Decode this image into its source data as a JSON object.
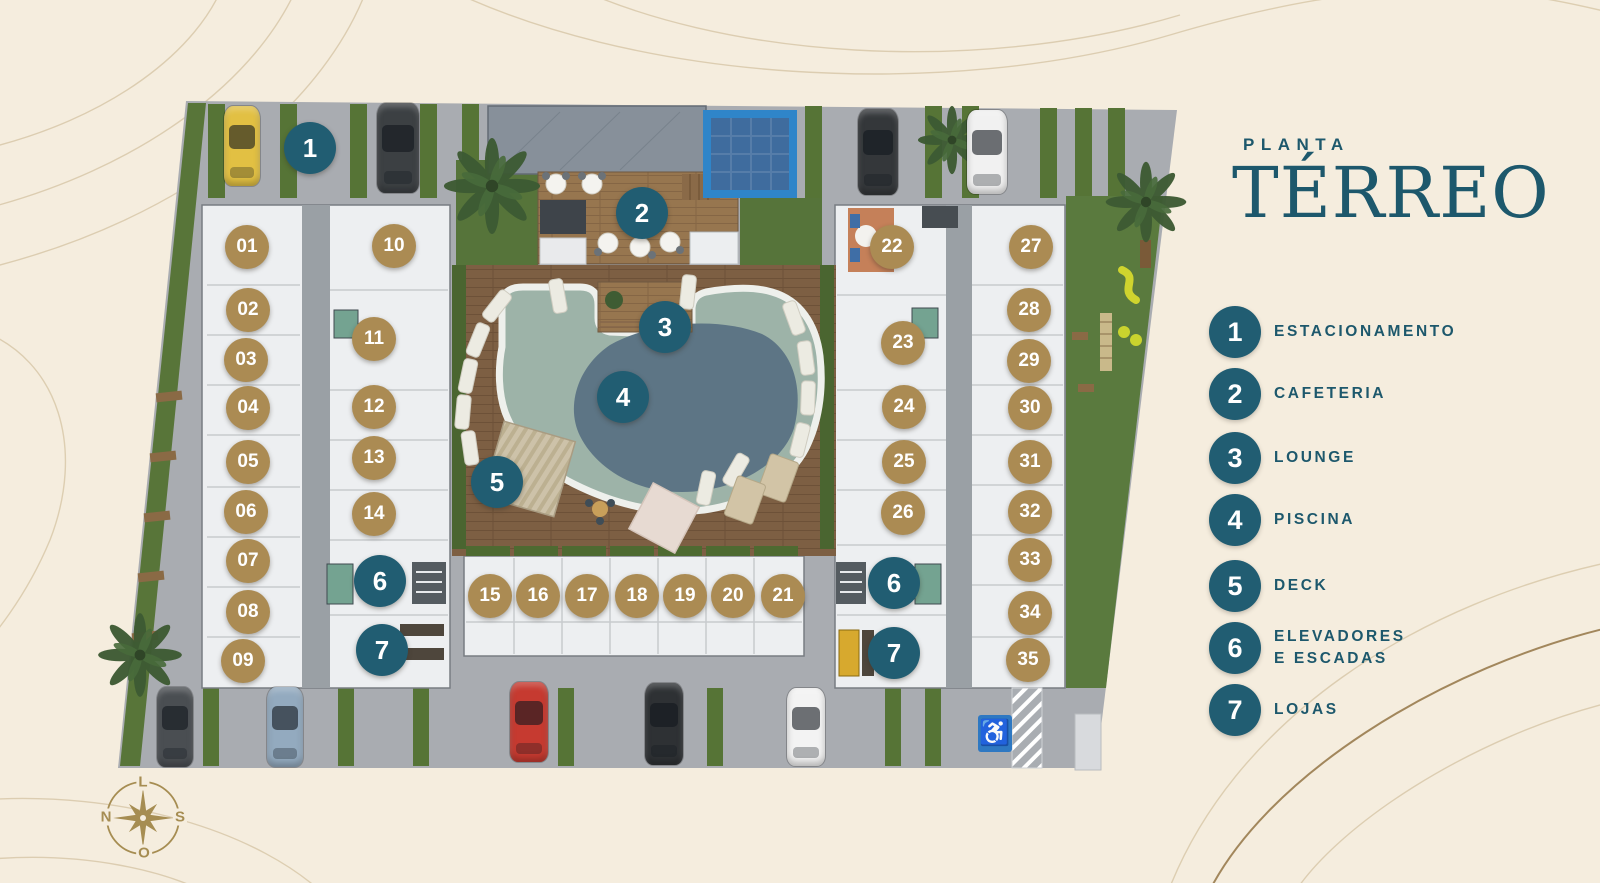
{
  "header": {
    "kicker": "PLANTA",
    "title": "TÉRREO"
  },
  "legend": {
    "items": [
      {
        "num": "1",
        "lines": [
          "ESTACIONAMENTO"
        ]
      },
      {
        "num": "2",
        "lines": [
          "CAFETERIA"
        ]
      },
      {
        "num": "3",
        "lines": [
          "LOUNGE"
        ]
      },
      {
        "num": "4",
        "lines": [
          "PISCINA"
        ]
      },
      {
        "num": "5",
        "lines": [
          "DECK"
        ]
      },
      {
        "num": "6",
        "lines": [
          "ELEVADORES",
          "E ESCADAS"
        ]
      },
      {
        "num": "7",
        "lines": [
          "LOJAS"
        ]
      }
    ]
  },
  "plan": {
    "unit_markers": [
      {
        "num": "01",
        "x": 247,
        "y": 247
      },
      {
        "num": "02",
        "x": 248,
        "y": 310
      },
      {
        "num": "03",
        "x": 246,
        "y": 360
      },
      {
        "num": "04",
        "x": 248,
        "y": 408
      },
      {
        "num": "05",
        "x": 248,
        "y": 462
      },
      {
        "num": "06",
        "x": 246,
        "y": 512
      },
      {
        "num": "07",
        "x": 248,
        "y": 561
      },
      {
        "num": "08",
        "x": 248,
        "y": 612
      },
      {
        "num": "09",
        "x": 243,
        "y": 661
      },
      {
        "num": "10",
        "x": 394,
        "y": 246
      },
      {
        "num": "11",
        "x": 374,
        "y": 339
      },
      {
        "num": "12",
        "x": 374,
        "y": 407
      },
      {
        "num": "13",
        "x": 374,
        "y": 458
      },
      {
        "num": "14",
        "x": 374,
        "y": 514
      },
      {
        "num": "15",
        "x": 490,
        "y": 596
      },
      {
        "num": "16",
        "x": 538,
        "y": 596
      },
      {
        "num": "17",
        "x": 587,
        "y": 596
      },
      {
        "num": "18",
        "x": 637,
        "y": 596
      },
      {
        "num": "19",
        "x": 685,
        "y": 596
      },
      {
        "num": "20",
        "x": 733,
        "y": 596
      },
      {
        "num": "21",
        "x": 783,
        "y": 596
      },
      {
        "num": "22",
        "x": 892,
        "y": 247
      },
      {
        "num": "23",
        "x": 903,
        "y": 343
      },
      {
        "num": "24",
        "x": 904,
        "y": 407
      },
      {
        "num": "25",
        "x": 904,
        "y": 462
      },
      {
        "num": "26",
        "x": 903,
        "y": 513
      },
      {
        "num": "27",
        "x": 1031,
        "y": 247
      },
      {
        "num": "28",
        "x": 1029,
        "y": 310
      },
      {
        "num": "29",
        "x": 1029,
        "y": 361
      },
      {
        "num": "30",
        "x": 1030,
        "y": 408
      },
      {
        "num": "31",
        "x": 1030,
        "y": 462
      },
      {
        "num": "32",
        "x": 1030,
        "y": 512
      },
      {
        "num": "33",
        "x": 1030,
        "y": 560
      },
      {
        "num": "34",
        "x": 1030,
        "y": 613
      },
      {
        "num": "35",
        "x": 1028,
        "y": 660
      }
    ],
    "amenity_markers": [
      {
        "num": "1",
        "x": 310,
        "y": 148
      },
      {
        "num": "2",
        "x": 642,
        "y": 213
      },
      {
        "num": "3",
        "x": 665,
        "y": 327
      },
      {
        "num": "4",
        "x": 623,
        "y": 397
      },
      {
        "num": "5",
        "x": 497,
        "y": 482
      },
      {
        "num": "6",
        "x": 380,
        "y": 581
      },
      {
        "num": "7",
        "x": 382,
        "y": 650
      },
      {
        "num": "6",
        "x": 894,
        "y": 583
      },
      {
        "num": "7",
        "x": 894,
        "y": 653
      }
    ],
    "cars": [
      {
        "color": "#e2c043",
        "x": 242,
        "y": 146,
        "w": 36,
        "h": 80
      },
      {
        "color": "#3c4043",
        "x": 398,
        "y": 148,
        "w": 42,
        "h": 90
      },
      {
        "color": "#34373a",
        "x": 878,
        "y": 152,
        "w": 40,
        "h": 86
      },
      {
        "color": "#f1f1f1",
        "x": 987,
        "y": 152,
        "w": 40,
        "h": 84
      },
      {
        "color": "#4a4e52",
        "x": 175,
        "y": 727,
        "w": 36,
        "h": 80
      },
      {
        "color": "#93aabf",
        "x": 285,
        "y": 727,
        "w": 36,
        "h": 80
      },
      {
        "color": "#c63a30",
        "x": 529,
        "y": 722,
        "w": 38,
        "h": 80
      },
      {
        "color": "#2e3134",
        "x": 664,
        "y": 724,
        "w": 38,
        "h": 82
      },
      {
        "color": "#f3f3f3",
        "x": 806,
        "y": 727,
        "w": 38,
        "h": 78
      }
    ],
    "accessible_symbol": "♿"
  },
  "compass": {
    "top": "L",
    "right": "S",
    "bottom": "O",
    "left": "N"
  },
  "colors": {
    "teal": "#215d72",
    "gold": "#ab8b53",
    "cream": "#f5edde",
    "title_teal": "#1d586c"
  }
}
